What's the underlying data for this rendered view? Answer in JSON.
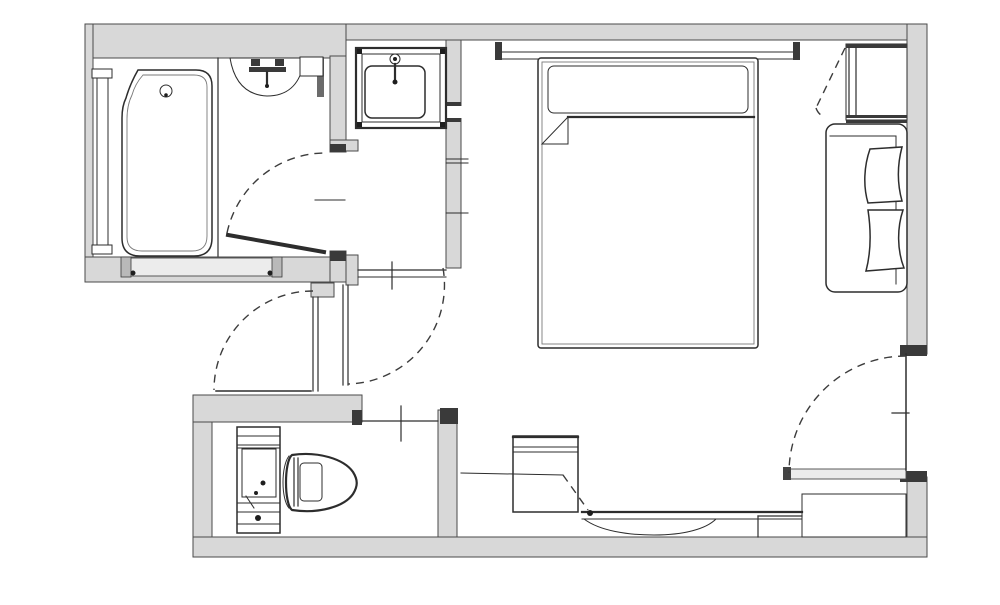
{
  "figure": {
    "kind": "architectural-floor-plan",
    "description": "Hotel guest room floor plan: unit bathroom with bathtub and window, vanity sink alcove, vestibule with swing doors, toilet room, bedroom with double bed and headboard, closet with luggage bench, desk with chair, and entrance door with step"
  },
  "colors": {
    "bg": "#ffffff",
    "wall": "#d8d8d8",
    "line": "#2d2d2d",
    "lite": "#ececec"
  },
  "rooms": [
    {
      "id": "bathroom"
    },
    {
      "id": "vanity-area"
    },
    {
      "id": "vestibule"
    },
    {
      "id": "toilet-room"
    },
    {
      "id": "bedroom"
    },
    {
      "id": "closet"
    },
    {
      "id": "desk-area"
    },
    {
      "id": "entrance"
    }
  ],
  "fixtures": [
    {
      "id": "bathtub"
    },
    {
      "id": "bath-window"
    },
    {
      "id": "shower-counter"
    },
    {
      "id": "vanity-sink"
    },
    {
      "id": "toilet"
    },
    {
      "id": "double-bed"
    },
    {
      "id": "luggage-bench"
    },
    {
      "id": "desk"
    },
    {
      "id": "desk-chair"
    },
    {
      "id": "entrance-step"
    }
  ]
}
